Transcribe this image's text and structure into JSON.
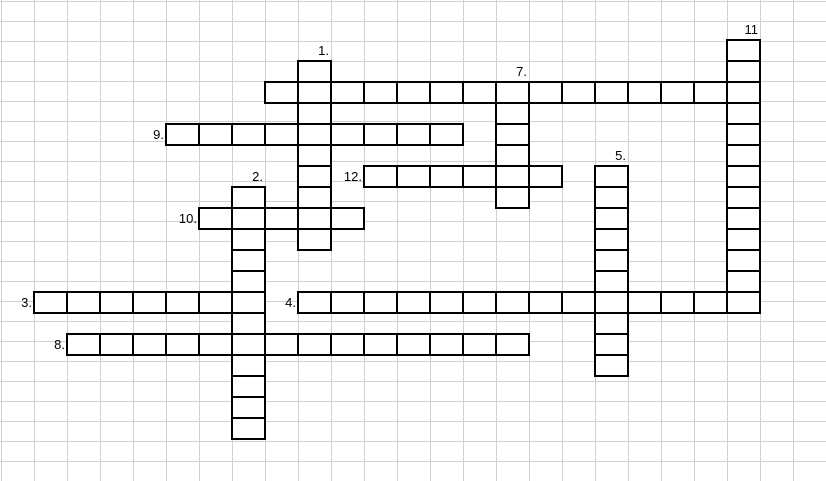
{
  "sheet": {
    "background_color": "#ffffff",
    "gridline_color": "#d0d0d0",
    "columns": 25,
    "rows": 24,
    "col_width": 33,
    "row_height": 20,
    "origin_x": 1,
    "origin_y": 1
  },
  "crossword": {
    "border_color": "#000000",
    "cell_fill": "#ffffff",
    "cell_width": 33,
    "cell_height": 21,
    "offset_x": 1,
    "offset_y": 40,
    "labels": [
      {
        "text": "1.",
        "row": 0,
        "col": 9
      },
      {
        "text": "2.",
        "row": 6,
        "col": 7
      },
      {
        "text": "3.",
        "row": 12,
        "col": 0
      },
      {
        "text": "4.",
        "row": 12,
        "col": 8
      },
      {
        "text": "5.",
        "row": 5,
        "col": 18
      },
      {
        "text": "7.",
        "row": 1,
        "col": 15
      },
      {
        "text": "8.",
        "row": 14,
        "col": 1
      },
      {
        "text": "9.",
        "row": 4,
        "col": 4
      },
      {
        "text": "10.",
        "row": 8,
        "col": 5
      },
      {
        "text": "11",
        "row": -1,
        "col": 22
      },
      {
        "text": "12.",
        "row": 6,
        "col": 10
      }
    ],
    "words": [
      {
        "number": "",
        "dir": "across",
        "row": 2,
        "col": 8,
        "length": 15
      },
      {
        "number": "9",
        "dir": "across",
        "row": 4,
        "col": 5,
        "length": 9
      },
      {
        "number": "12",
        "dir": "across",
        "row": 6,
        "col": 11,
        "length": 6
      },
      {
        "number": "10",
        "dir": "across",
        "row": 8,
        "col": 6,
        "length": 5
      },
      {
        "number": "3",
        "dir": "across",
        "row": 12,
        "col": 1,
        "length": 7
      },
      {
        "number": "4",
        "dir": "across",
        "row": 12,
        "col": 9,
        "length": 14
      },
      {
        "number": "8",
        "dir": "across",
        "row": 14,
        "col": 2,
        "length": 14
      },
      {
        "number": "1",
        "dir": "down",
        "row": 1,
        "col": 9,
        "length": 9
      },
      {
        "number": "2",
        "dir": "down",
        "row": 7,
        "col": 7,
        "length": 12
      },
      {
        "number": "5",
        "dir": "down",
        "row": 6,
        "col": 18,
        "length": 10
      },
      {
        "number": "7",
        "dir": "down",
        "row": 2,
        "col": 15,
        "length": 6
      },
      {
        "number": "11",
        "dir": "down",
        "row": 0,
        "col": 22,
        "length": 13
      }
    ]
  }
}
